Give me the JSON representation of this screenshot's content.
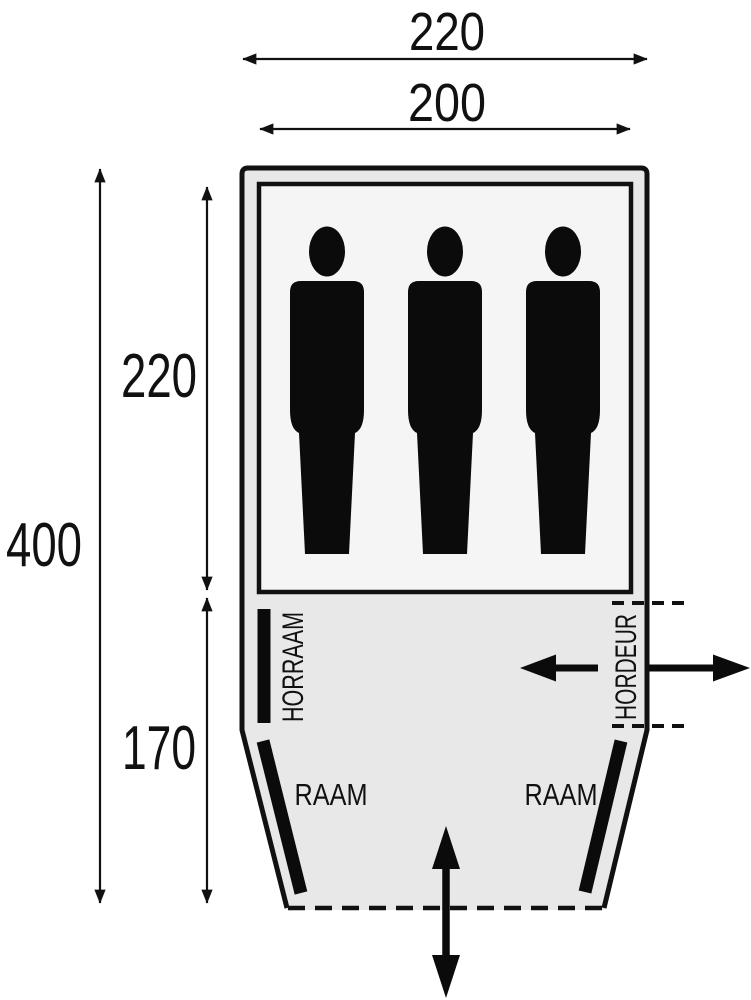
{
  "diagram": {
    "kind": "tent-floorplan-top-view",
    "colors": {
      "line": "#111111",
      "tent_fill": "#e8e8e8",
      "cabin_fill": "#f5f5f5",
      "background": "#ffffff"
    },
    "dimensions": {
      "outer_width": "220",
      "inner_width": "200",
      "total_depth": "400",
      "cabin_depth": "220",
      "porch_depth": "170"
    },
    "labels": {
      "horraam": "HORRAAM",
      "hordeur": "HORDEUR",
      "raam_left": "RAAM",
      "raam_right": "RAAM"
    },
    "occupants": {
      "count": 3,
      "icon": "person-silhouette"
    },
    "icons": {
      "entrance": "double-vertical-arrow",
      "door_in": "left-arrow",
      "door_out": "right-arrow"
    }
  }
}
